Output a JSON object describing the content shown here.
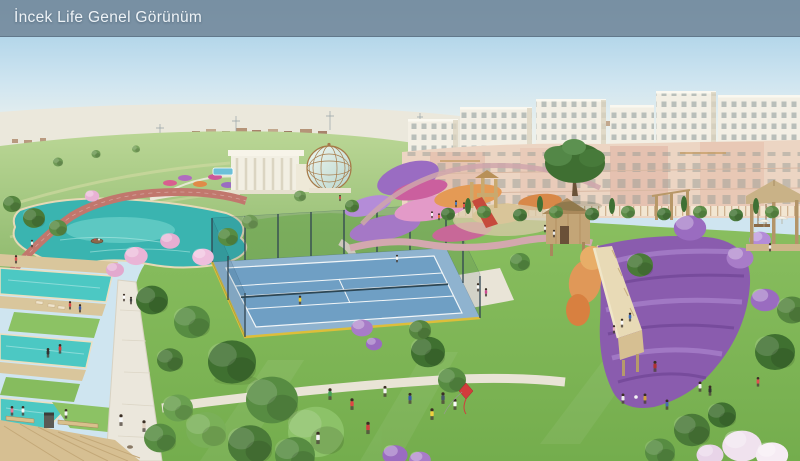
{
  "header": {
    "title": "İncek Life Genel Görünüm"
  },
  "scene": {
    "type": "architectural-aerial-render",
    "features": [
      "sky",
      "distant-plain",
      "meadow",
      "apartment-blocks",
      "townhouses",
      "conservatory-dome",
      "lake",
      "jogging-track",
      "terraced-pools",
      "wooden-decks",
      "tennis-court",
      "flower-gardens",
      "playground",
      "lavender-hill",
      "boardwalk-ramp",
      "gazebo",
      "lawns",
      "trees",
      "people",
      "kite"
    ]
  },
  "palette": {
    "header_bar": "#72869a",
    "sky_blue": "#9ecbe5",
    "meadow_green": "#9cc278",
    "lawn_green": "#7fb556",
    "pool_turquoise": "#4cc8c3",
    "lake_teal": "#3ab4b0",
    "court_blue": "#6f9fc4",
    "lavender_purple": "#8a5cae",
    "flower_pink": "#e39ac8",
    "flower_orange": "#e49a55",
    "path_cream": "#ebe7dc",
    "deck_wood": "#d6bf92",
    "building_cream": "#f3efe4",
    "townhouse_rose": "#ecd5c3"
  }
}
